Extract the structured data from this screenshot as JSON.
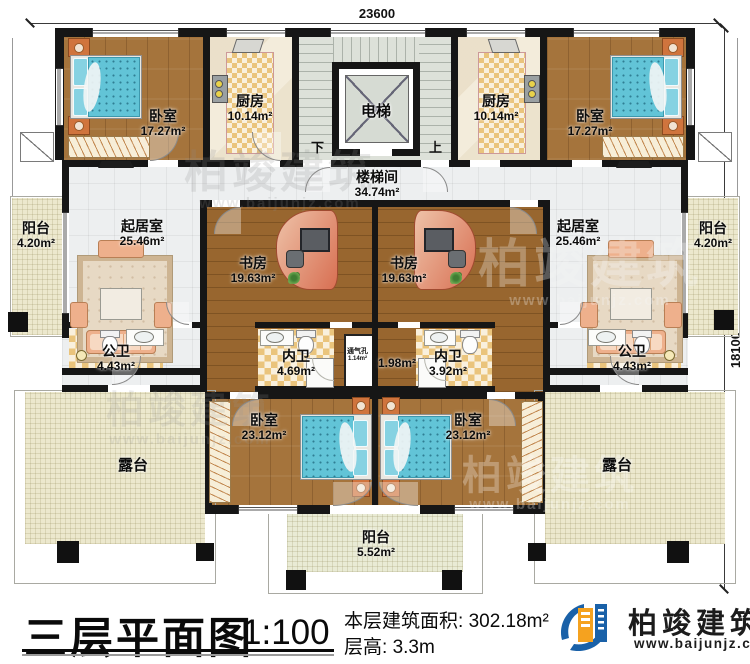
{
  "dimensions": {
    "top": "23600",
    "right": "18100"
  },
  "stair": {
    "down": "下",
    "up": "上",
    "elevator": "电梯"
  },
  "rooms": {
    "bedroom_tl": {
      "label": "卧室",
      "area": "17.27m²"
    },
    "bedroom_tr": {
      "label": "卧室",
      "area": "17.27m²"
    },
    "kitchen_l": {
      "label": "厨房",
      "area": "10.14m²"
    },
    "kitchen_r": {
      "label": "厨房",
      "area": "10.14m²"
    },
    "stairwell": {
      "label": "楼梯间",
      "area": "34.74m²"
    },
    "balcony_l": {
      "label": "阳台",
      "area": "4.20m²"
    },
    "balcony_r": {
      "label": "阳台",
      "area": "4.20m²"
    },
    "living_l": {
      "label": "起居室",
      "area": "25.46m²"
    },
    "living_r": {
      "label": "起居室",
      "area": "25.46m²"
    },
    "study_l": {
      "label": "书房",
      "area": "19.63m²"
    },
    "study_r": {
      "label": "书房",
      "area": "19.63m²"
    },
    "bath_public_l": {
      "label": "公卫",
      "area": "4.43m²"
    },
    "bath_public_r": {
      "label": "公卫",
      "area": "4.43m²"
    },
    "bath_private_l": {
      "label": "内卫",
      "area": "4.69m²"
    },
    "bath_private_r": {
      "label": "内卫",
      "area": "3.92m²"
    },
    "vent": {
      "label": "通气孔",
      "area": "1.14m²"
    },
    "vent_r": {
      "label": "",
      "area": "1.98m²"
    },
    "bedroom_bl": {
      "label": "卧室",
      "area": "23.12m²"
    },
    "bedroom_br": {
      "label": "卧室",
      "area": "23.12m²"
    },
    "terrace_l": {
      "label": "露台"
    },
    "terrace_r": {
      "label": "露台"
    },
    "balcony_b": {
      "label": "阳台",
      "area": "5.52m²"
    }
  },
  "footer": {
    "plan_title": "三层平面图",
    "scale": "1:100",
    "floor_area_label": "本层建筑面积:",
    "floor_area_value": "302.18m²",
    "floor_height_label": "层高:",
    "floor_height_value": "3.3m"
  },
  "logo": {
    "name": "柏竣建筑",
    "website": "www.baijunjz.com"
  },
  "watermark": {
    "brand": "柏竣建筑",
    "website": "www.baijunjz.com"
  },
  "colors": {
    "wall": "#161616",
    "wood": "#a5743c",
    "wood_dark": "#98662f",
    "bed": "#62c4d7",
    "checker": "#eac47c",
    "balcony": "#ece8cd",
    "tile": "#edeff0",
    "stair": "#dde1d9",
    "logo_blue": "#1a61a8",
    "logo_orange": "#f5a21f"
  }
}
